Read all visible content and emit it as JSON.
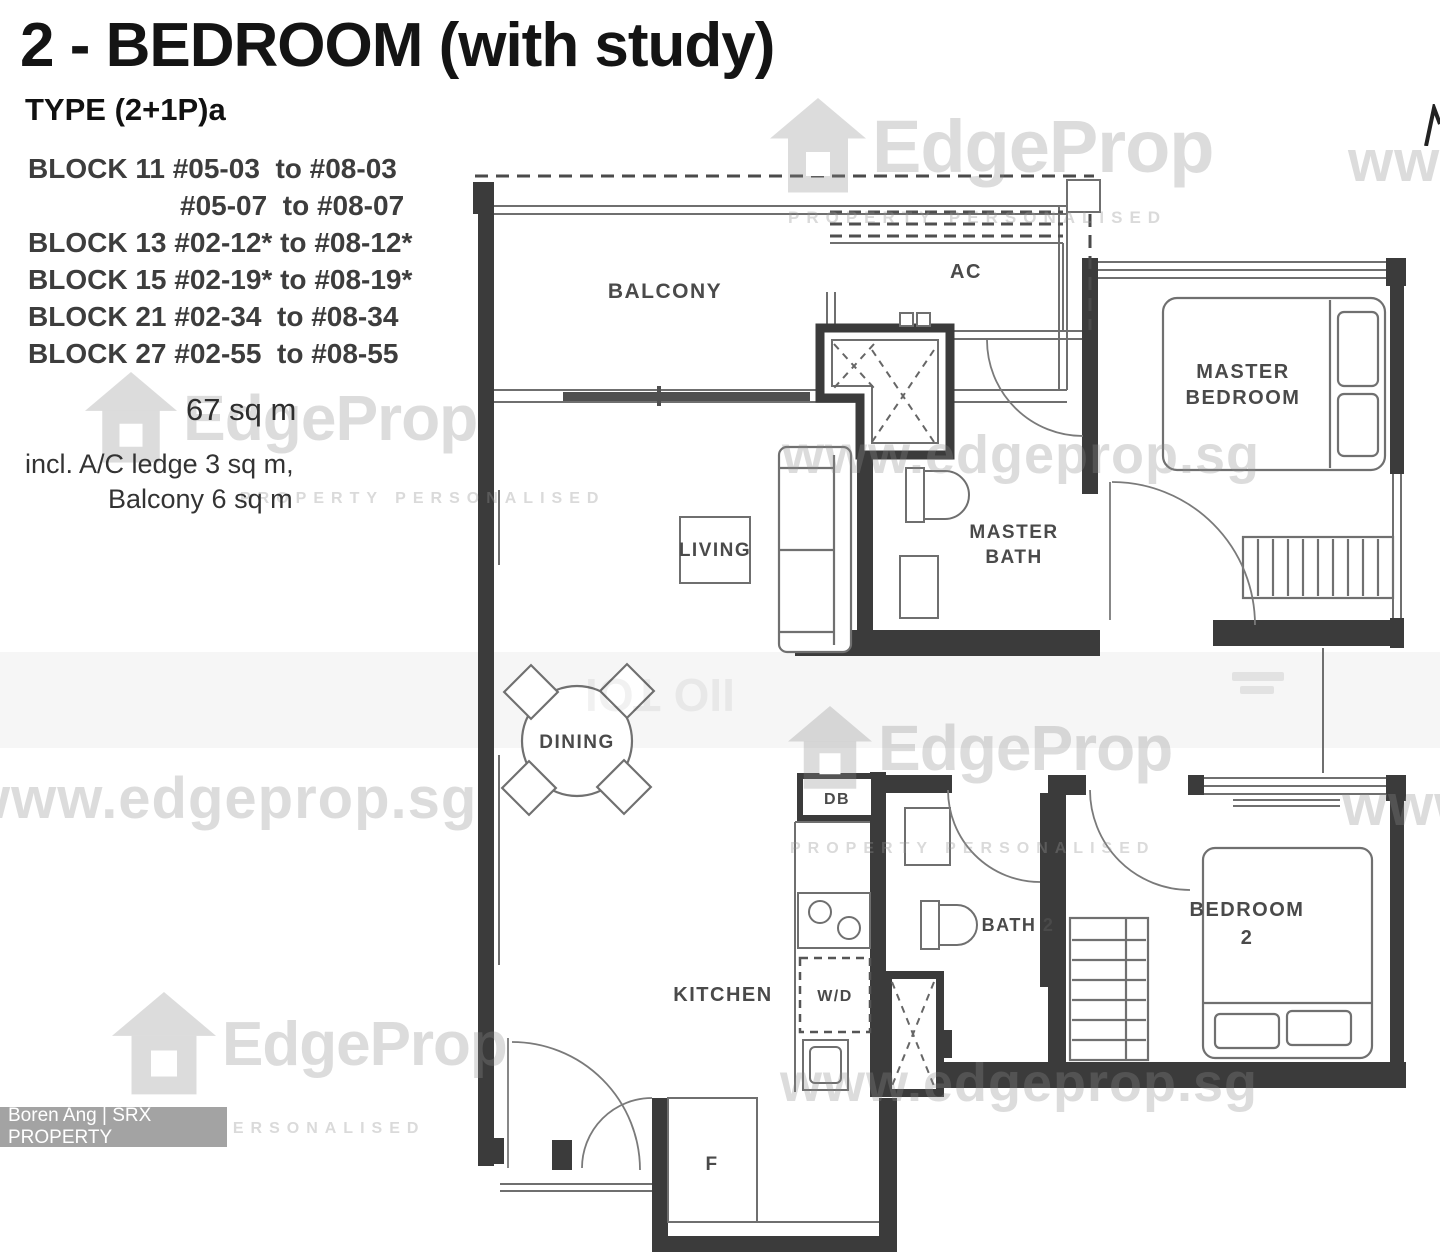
{
  "header": {
    "title": "2 - BEDROOM (with study)",
    "type_label": "TYPE (2+1P)a"
  },
  "blocks": [
    "BLOCK 11 #05-03  to #08-03",
    "#05-07  to #08-07",
    "BLOCK 13 #02-12* to #08-12*",
    "BLOCK 15 #02-19* to #08-19*",
    "BLOCK 21 #02-34  to #08-34",
    "BLOCK 27 #02-55  to #08-55"
  ],
  "area": {
    "size": "67 sq m",
    "includes_line1": "incl. A/C ledge 3 sq m,",
    "includes_line2": "Balcony 6 sq m"
  },
  "rooms": {
    "balcony": "BALCONY",
    "ac": "AC",
    "master_bedroom": [
      "MASTER",
      "BEDROOM"
    ],
    "living": "LIVING",
    "master_bath": [
      "MASTER",
      "BATH"
    ],
    "dining": "DINING",
    "db": "DB",
    "bath2": "BATH 2",
    "kitchen": "KITCHEN",
    "wd": "W/D",
    "bedroom2": [
      "BEDROOM",
      "2"
    ],
    "fridge": "F"
  },
  "watermark": {
    "brand": "EdgeProp",
    "tagline": "PROPERTY PERSONALISED",
    "url": "www.edgeprop.sg",
    "www_short": "www",
    "flipped_fragment": "IIO TOI"
  },
  "credit": "Boren Ang | SRX PROPERTY",
  "colors": {
    "wall": "#3b3b3b",
    "line": "#6f6f6f",
    "label": "#4a4a4a",
    "watermark": "#d9d9d9",
    "badge_bg": "#a3a3a3",
    "badge_text": "#ffffff"
  }
}
